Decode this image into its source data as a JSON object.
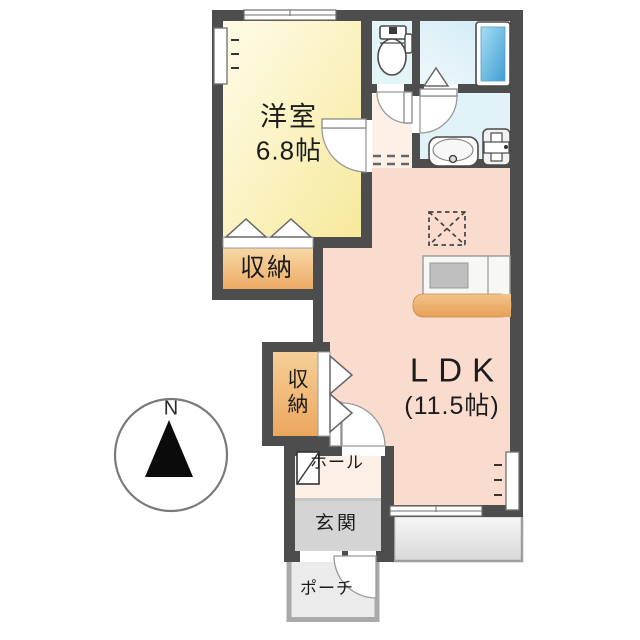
{
  "floorplan": {
    "compass_label": "N",
    "wall_color": "#4d4d4d",
    "rooms": {
      "western_room": {
        "label": "洋室",
        "size": "6.8帖",
        "color": "#f8efae"
      },
      "ldk": {
        "label": "LDK",
        "size": "(11.5帖)",
        "color": "#fadcce"
      },
      "closet_upper": {
        "label": "収納",
        "color": "#f2c285"
      },
      "closet_lower": {
        "label": "収納",
        "color": "#f2c285"
      },
      "hall": {
        "label": "ホール",
        "color": "#fdf1e7"
      },
      "entrance": {
        "label": "玄関",
        "color": "#d4d4d4"
      },
      "porch": {
        "label": "ポーチ",
        "color": "#ebebeb"
      },
      "toilet": {
        "color": "#e4f5f8"
      },
      "bathroom": {
        "color": "#daeff7"
      },
      "washroom": {
        "color": "#e1f3f7"
      },
      "terrace": {
        "color": "#e3e3e3"
      }
    },
    "fixtures": [
      "toilet",
      "bathtub",
      "washbasin",
      "washing-machine-pan",
      "range-hood",
      "kitchen-counter",
      "shoe-cabinet"
    ]
  }
}
